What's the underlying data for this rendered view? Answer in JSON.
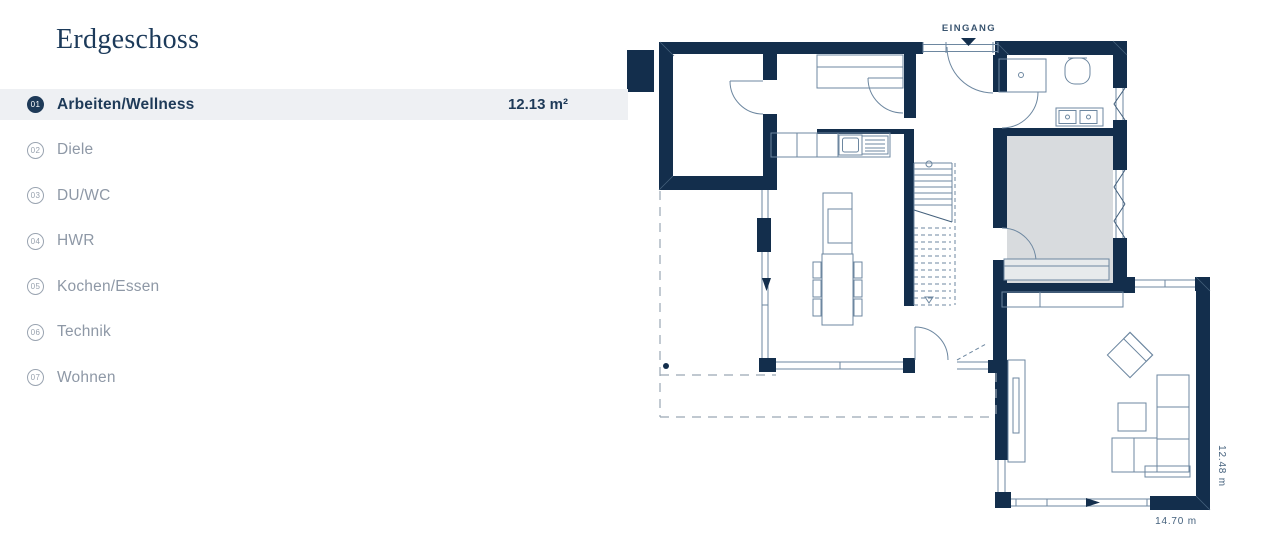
{
  "sidebar": {
    "title": "Erdgeschoss",
    "rooms": [
      {
        "number": "01",
        "label": "Arbeiten/Wellness",
        "area": "12.13 m²",
        "selected": true
      },
      {
        "number": "02",
        "label": "Diele",
        "area": "",
        "selected": false
      },
      {
        "number": "03",
        "label": "DU/WC",
        "area": "",
        "selected": false
      },
      {
        "number": "04",
        "label": "HWR",
        "area": "",
        "selected": false
      },
      {
        "number": "05",
        "label": "Kochen/Essen",
        "area": "",
        "selected": false
      },
      {
        "number": "06",
        "label": "Technik",
        "area": "",
        "selected": false
      },
      {
        "number": "07",
        "label": "Wohnen",
        "area": "",
        "selected": false
      }
    ]
  },
  "floorplan": {
    "entrance_label": "EINGANG",
    "width_dimension": "14.70 m",
    "height_dimension": "12.48 m",
    "selected_room_number": "01",
    "colors": {
      "wall": "#132e4c",
      "line": "#6d87a0",
      "selected_room_fill": "#d8dbde",
      "dashed": "#9aa7b3"
    }
  },
  "ui_colors": {
    "selected_row_bg": "#eef0f3",
    "text_primary": "#1e3a58",
    "text_muted": "#8e98a6"
  }
}
